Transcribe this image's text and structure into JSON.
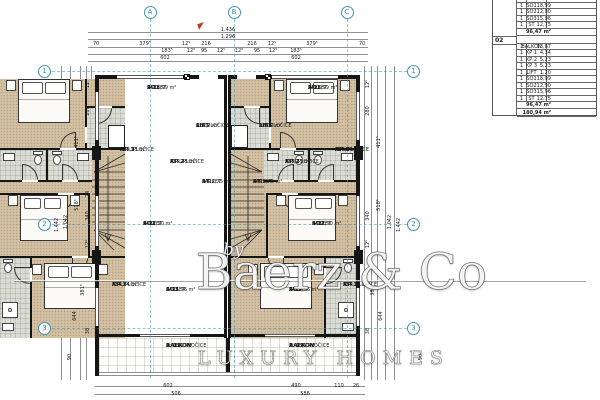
{
  "watermark": {
    "prefix": "by",
    "brand": "Baerz & Co",
    "tagline": "LUXURY HOMES"
  },
  "area_table": {
    "section_01": {
      "rows": [
        [
          "1",
          "LIFT",
          "1,20"
        ],
        [
          "1",
          "SO1",
          "18,99"
        ],
        [
          "1",
          "SO2",
          "12,90"
        ],
        [
          "1",
          "SO3",
          "15,96"
        ],
        [
          "1",
          "ST",
          "12,75"
        ]
      ],
      "subtotal": "96,47 m²"
    },
    "section_02": {
      "label": "02",
      "rows": [
        [
          "1",
          "BALKON",
          "13,87"
        ],
        [
          "1",
          "KP 1",
          "4,34"
        ],
        [
          "1",
          "KP 2",
          "5,23"
        ],
        [
          "1",
          "KP 3",
          "5,23"
        ],
        [
          "1",
          "LIFT",
          "1,20"
        ],
        [
          "1",
          "SO1",
          "18,99"
        ],
        [
          "1",
          "SO2",
          "12,90"
        ],
        [
          "1",
          "SO3",
          "15,96"
        ],
        [
          "1",
          "ST",
          "12,75"
        ]
      ],
      "subtotal": "96,47 m²"
    },
    "grand_total": "180,94 m²"
  },
  "axes": {
    "columns": [
      {
        "label": "A",
        "x": 150
      },
      {
        "label": "B",
        "x": 234
      },
      {
        "label": "C",
        "x": 347
      }
    ],
    "rows": [
      {
        "label": "1",
        "y": 71
      },
      {
        "label": "2",
        "y": 224
      },
      {
        "label": "3",
        "y": 328
      }
    ]
  },
  "room_labels": [
    {
      "x": 147,
      "y": 86,
      "lines": [
        "SO1",
        "A: 18,99 m²",
        "PARKET"
      ]
    },
    {
      "x": 308,
      "y": 86,
      "lines": [
        "SO1",
        "A: 18,99 m²",
        "PARKET"
      ]
    },
    {
      "x": 120,
      "y": 148,
      "lines": [
        "KP 3",
        "A: 5,23 m²",
        "KER. PLOČICE"
      ]
    },
    {
      "x": 335,
      "y": 148,
      "lines": [
        "KP 3",
        "A: 5,23 m²",
        "KER. PLOČICE"
      ]
    },
    {
      "x": 170,
      "y": 160,
      "lines": [
        "KP 2",
        "A: 5,23 m²",
        "KER. PLOČICE"
      ]
    },
    {
      "x": 285,
      "y": 160,
      "lines": [
        "KP 2",
        "A: 5,23 m²",
        "KER. PLOČICE"
      ]
    },
    {
      "x": 196,
      "y": 124,
      "lines": [
        "LIFT",
        "01",
        "A: 1,2 m²",
        "KER.PLOČICE"
      ]
    },
    {
      "x": 259,
      "y": 124,
      "lines": [
        "LIFT",
        "02",
        "A: 1,2 m²",
        "KER.PLOČICE"
      ]
    },
    {
      "x": 202,
      "y": 180,
      "lines": [
        "ST",
        "A: 12,75 m²",
        "PARKET"
      ]
    },
    {
      "x": 253,
      "y": 180,
      "lines": [
        "ST",
        "A: 12,75 m²",
        "PARKET"
      ]
    },
    {
      "x": 143,
      "y": 222,
      "lines": [
        "SO2",
        "A: 12,90 m²",
        "PARKET"
      ]
    },
    {
      "x": 312,
      "y": 222,
      "lines": [
        "SO2",
        "A: 12,90 m²",
        "PARKET"
      ]
    },
    {
      "x": 112,
      "y": 283,
      "lines": [
        "KP 1",
        "A: 4,34 m²",
        "KER. PLOČICE"
      ]
    },
    {
      "x": 343,
      "y": 283,
      "lines": [
        "KP 1",
        "A: 4,34 m²",
        "KER. PLOČICE"
      ]
    },
    {
      "x": 166,
      "y": 288,
      "lines": [
        "SO3",
        "A: 15,96 m²",
        "PARKET"
      ]
    },
    {
      "x": 289,
      "y": 288,
      "lines": [
        "SO3",
        "A: 15,96 m²",
        "PARKET"
      ]
    },
    {
      "x": 166,
      "y": 344,
      "lines": [
        "BALKON",
        "P: KER. PLOČICE",
        "A: 13,9 m²"
      ]
    },
    {
      "x": 289,
      "y": 344,
      "lines": [
        "BALKON",
        "P: KER. PLOČICE",
        "A: 13,9 m²"
      ]
    }
  ],
  "dimensions": [
    {
      "t": "1.436",
      "x": 228,
      "y": 30
    },
    {
      "t": "1.296",
      "x": 228,
      "y": 37
    },
    {
      "t": "70",
      "x": 96,
      "y": 44
    },
    {
      "t": "379⁵",
      "x": 145,
      "y": 44
    },
    {
      "t": "12⁵",
      "x": 186,
      "y": 44
    },
    {
      "t": "216",
      "x": 206,
      "y": 44
    },
    {
      "t": "216",
      "x": 252,
      "y": 44
    },
    {
      "t": "12⁵",
      "x": 272,
      "y": 44
    },
    {
      "t": "379⁵",
      "x": 312,
      "y": 44
    },
    {
      "t": "70",
      "x": 362,
      "y": 44
    },
    {
      "t": "183⁵",
      "x": 167,
      "y": 51
    },
    {
      "t": "12⁵",
      "x": 191,
      "y": 51
    },
    {
      "t": "95",
      "x": 204,
      "y": 51
    },
    {
      "t": "12⁵",
      "x": 221,
      "y": 51
    },
    {
      "t": "12⁵",
      "x": 239,
      "y": 51
    },
    {
      "t": "95",
      "x": 257,
      "y": 51
    },
    {
      "t": "12⁵",
      "x": 273,
      "y": 51
    },
    {
      "t": "183⁵",
      "x": 296,
      "y": 51
    },
    {
      "t": "602",
      "x": 165,
      "y": 58
    },
    {
      "t": "602",
      "x": 296,
      "y": 58
    },
    {
      "t": "602",
      "x": 168,
      "y": 386
    },
    {
      "t": "506",
      "x": 176,
      "y": 394
    },
    {
      "t": "490",
      "x": 296,
      "y": 386
    },
    {
      "t": "110",
      "x": 339,
      "y": 386
    },
    {
      "t": "26",
      "x": 356,
      "y": 386
    },
    {
      "t": "586",
      "x": 305,
      "y": 394
    },
    {
      "t": "90",
      "x": 70,
      "y": 357,
      "r": -90
    },
    {
      "t": "90",
      "x": 421,
      "y": 357,
      "r": -90
    },
    {
      "t": "12⁵",
      "x": 88,
      "y": 84,
      "r": -90
    },
    {
      "t": "280",
      "x": 88,
      "y": 111,
      "r": -90
    },
    {
      "t": "411⁵",
      "x": 77,
      "y": 142,
      "r": -90
    },
    {
      "t": "24",
      "x": 88,
      "y": 194,
      "r": -90
    },
    {
      "t": "340",
      "x": 88,
      "y": 216,
      "r": -90
    },
    {
      "t": "12⁵",
      "x": 88,
      "y": 244,
      "r": -90
    },
    {
      "t": "381⁵",
      "x": 83,
      "y": 290,
      "r": -90
    },
    {
      "t": "644",
      "x": 75,
      "y": 316,
      "r": -90
    },
    {
      "t": "38",
      "x": 88,
      "y": 331,
      "r": -90
    },
    {
      "t": "518⁵",
      "x": 77,
      "y": 205,
      "r": -90
    },
    {
      "t": "1.042",
      "x": 66,
      "y": 222,
      "r": -90
    },
    {
      "t": "1.442",
      "x": 57,
      "y": 225,
      "r": -90
    },
    {
      "t": "12⁵",
      "x": 368,
      "y": 84,
      "r": -90
    },
    {
      "t": "280",
      "x": 368,
      "y": 111,
      "r": -90
    },
    {
      "t": "411⁵",
      "x": 379,
      "y": 142,
      "r": -90
    },
    {
      "t": "340",
      "x": 368,
      "y": 216,
      "r": -90
    },
    {
      "t": "12⁵",
      "x": 368,
      "y": 244,
      "r": -90
    },
    {
      "t": "381⁵",
      "x": 373,
      "y": 290,
      "r": -90
    },
    {
      "t": "644",
      "x": 381,
      "y": 316,
      "r": -90
    },
    {
      "t": "38",
      "x": 368,
      "y": 331,
      "r": -90
    },
    {
      "t": "518⁵",
      "x": 379,
      "y": 205,
      "r": -90
    },
    {
      "t": "1.042",
      "x": 390,
      "y": 222,
      "r": -90
    },
    {
      "t": "1.442",
      "x": 399,
      "y": 225,
      "r": -90
    }
  ]
}
